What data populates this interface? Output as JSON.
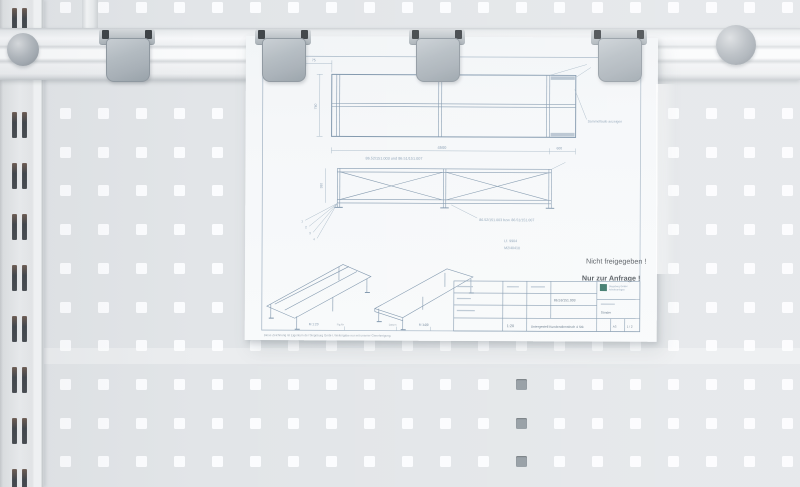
{
  "colors": {
    "pegboard": "#e2e5e8",
    "hole": "#fbfcfe",
    "hole_dark": "#8e979e",
    "rail": "#f5f6f8",
    "clip": "#a9b1b8",
    "knob": "#a4abb2",
    "paper": "#f5f7f9",
    "ink": "#7e95ab",
    "stamp_text": "#4a5056",
    "logo_green": "#2e6e5f"
  },
  "sheet": {
    "stamps": {
      "line1": "Nicht freigegeben !",
      "line2": "Nur zur Anfrage !"
    },
    "plan_view": {
      "dim_width": "75",
      "dim_depth": "740",
      "note": "Sammellaufe anzeigen"
    },
    "elevation": {
      "dim_total": "4500",
      "dim_end": "600",
      "dim_height": "380",
      "label_top": "86.52/151.003 und 86.51/151.007",
      "label_bottom": "86.52/151.003 bzw. 86.51/151.007",
      "callouts": [
        "1",
        "2",
        "3",
        "4"
      ]
    },
    "ref": {
      "line1": "Lf. 9904",
      "line2": "M2/40410"
    },
    "iso": {
      "scale_left": "M 1:20",
      "scale_right": "M 1:20"
    },
    "bottom_strip": {
      "t1": "Fig.Nr",
      "t2": "Datum",
      "t3": "Gepr."
    },
    "footer": "Diese Zeichnung ist Eigentum der Siegeburg GmbH. Weitergabe nur mit unserer Genehmigung.",
    "title_block": {
      "company_line1": "Siegeburg GmbH",
      "company_line2": "Arbeitsanlagen",
      "customer": "Sander",
      "drawing_no": "86.53/151.003",
      "scale": "1:20",
      "title": "Untergestell Kundendienstisch 4 Stk",
      "format": "A3",
      "sheet_no": "1 / 2"
    }
  }
}
